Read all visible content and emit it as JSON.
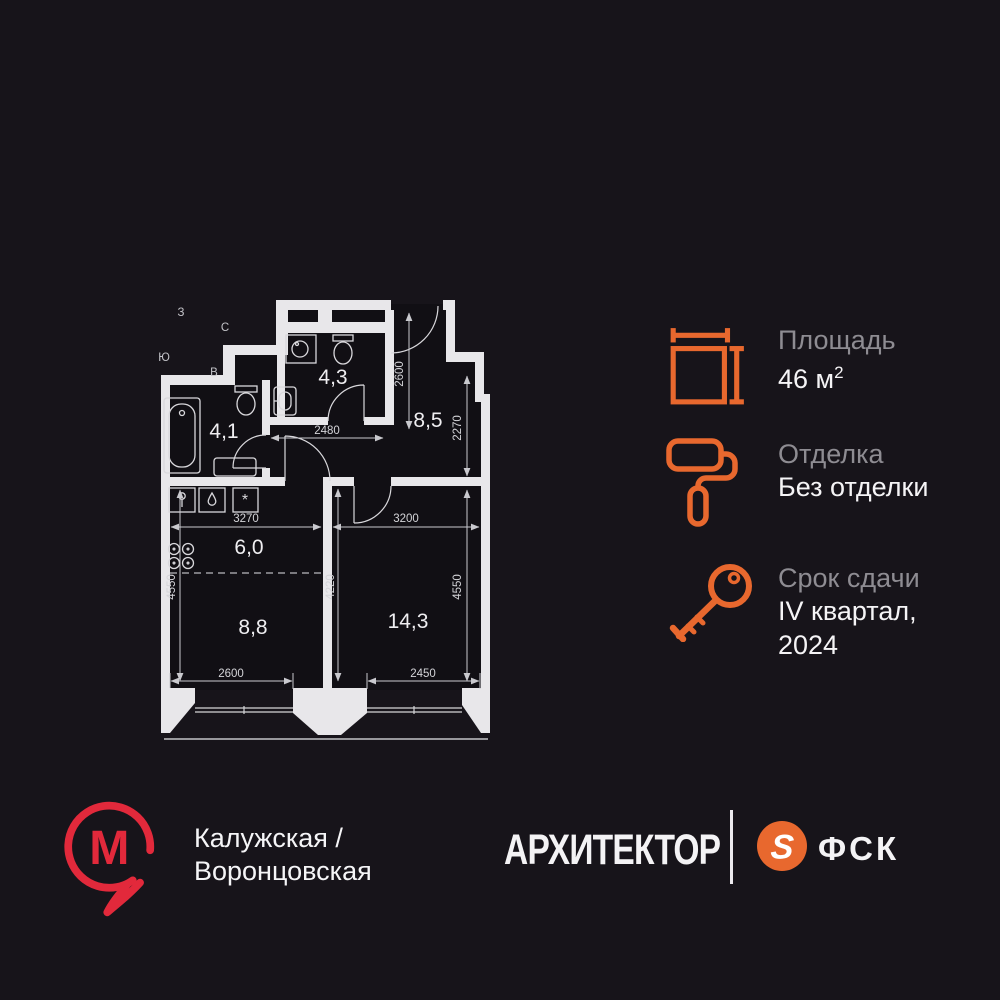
{
  "info_panel": {
    "items": [
      {
        "icon": "area-icon",
        "label": "Площадь",
        "value": "46 м",
        "sup": "2"
      },
      {
        "icon": "paint-roller-icon",
        "label": "Отделка",
        "value": "Без отделки"
      },
      {
        "icon": "key-icon",
        "label": "Срок сдачи",
        "value_line1": "IV квартал,",
        "value_line2": "2024"
      }
    ]
  },
  "floor_plan": {
    "compass": {
      "west": "З",
      "north": "С",
      "south": "Ю",
      "east": "В"
    },
    "rooms": [
      {
        "name": "bathroom-left",
        "label": "4,1"
      },
      {
        "name": "bathroom-top",
        "label": "4,3"
      },
      {
        "name": "hallway",
        "label": "8,5"
      },
      {
        "name": "kitchen",
        "label": "6,0"
      },
      {
        "name": "living",
        "label": "8,8"
      },
      {
        "name": "bedroom",
        "label": "14,3"
      }
    ],
    "dimensions": {
      "hall_v": "2600",
      "entry_v": "2270",
      "corridor_h": "2480",
      "kitchen_h": "3270",
      "bedroom_h": "3200",
      "central_v": "4220",
      "left_v": "4550",
      "right_v": "4550",
      "bottom_left": "2600",
      "bottom_right": "2450"
    }
  },
  "footer": {
    "metro": {
      "letter": "М",
      "stations_line1": "Калужская /",
      "stations_line2": "Воронцовская"
    },
    "developer_logo": "АРХИТЕКТОР",
    "brand": {
      "symbol": "S",
      "name": "ФСК"
    }
  },
  "colors": {
    "background": "#17141A",
    "wall": "#E8E7EA",
    "accent_orange": "#E8682E",
    "metro_red": "#E2293B",
    "label_gray": "#8E8C92",
    "value_white": "#F5F4F6"
  }
}
